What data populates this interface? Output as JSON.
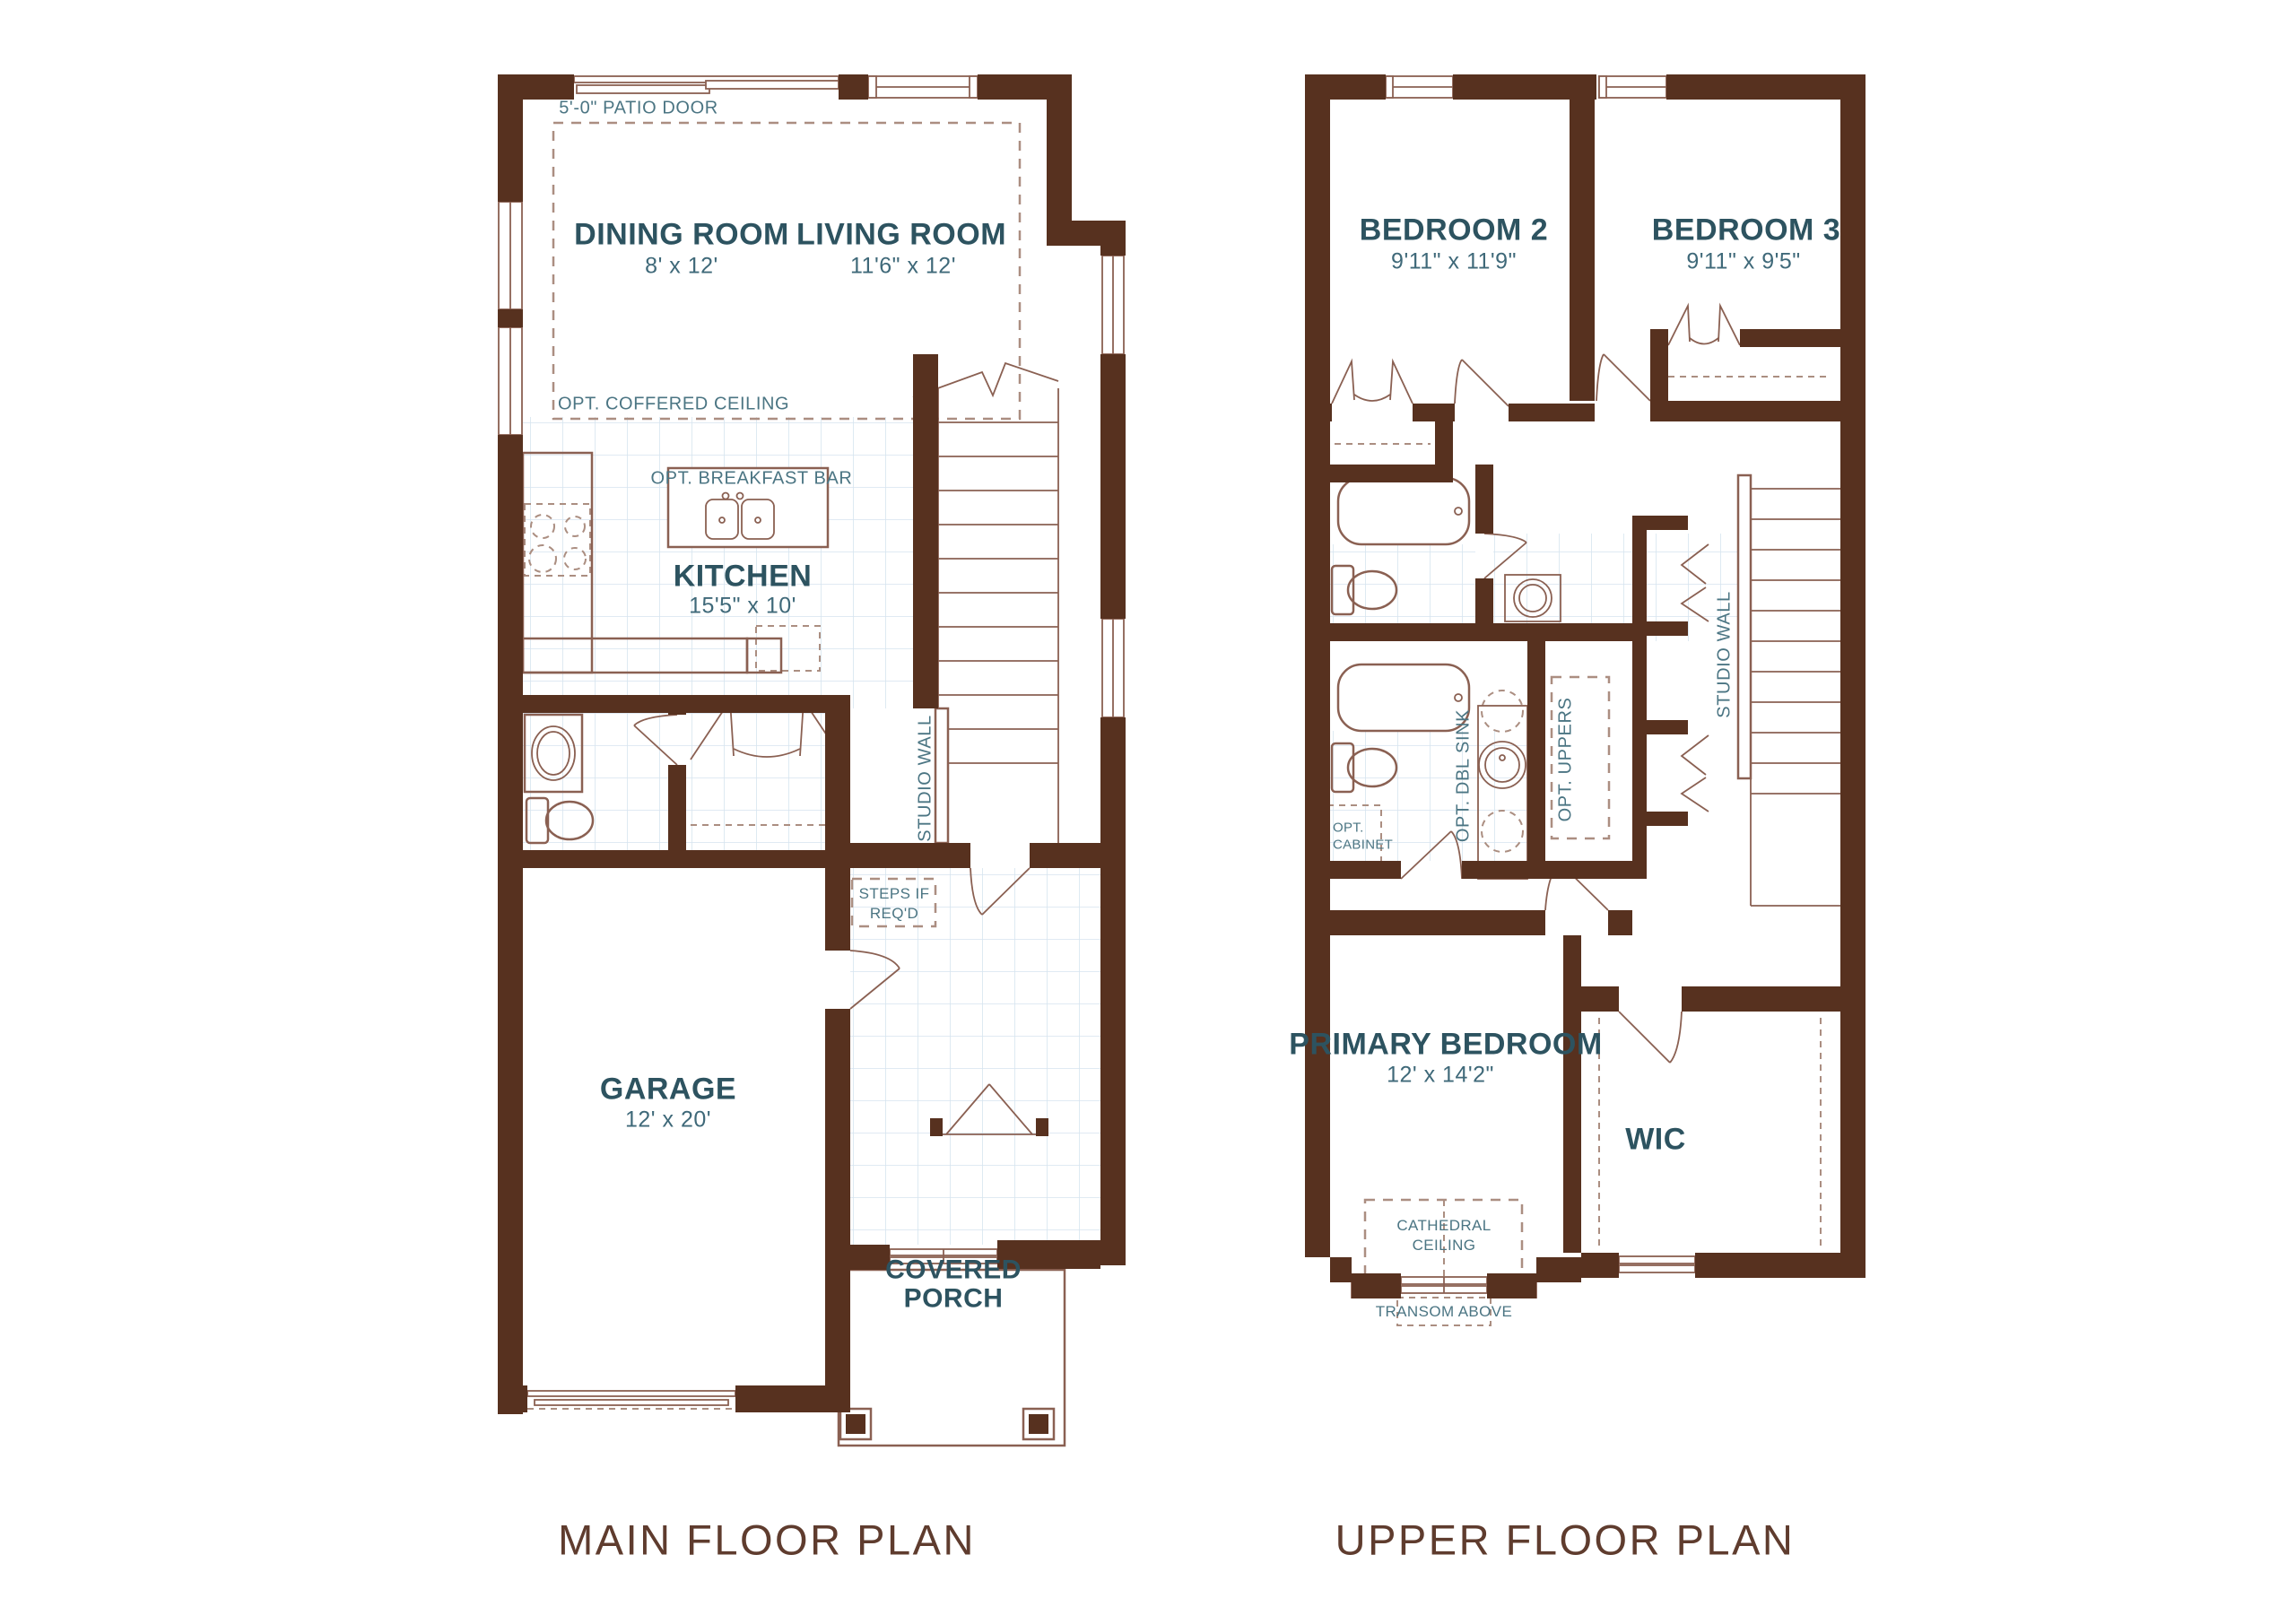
{
  "colors": {
    "wall": "#57311f",
    "line": "#8a6052",
    "dashed": "#ab8e81",
    "tile_grid": "#d6e4ef",
    "room_label": "#2d5360",
    "annotation": "#4b7583",
    "title": "#5f3c2e"
  },
  "main_floor": {
    "title": "MAIN FLOOR PLAN",
    "patio_door": "5'-0\" PATIO DOOR",
    "coffered": "OPT. COFFERED CEILING",
    "breakfast_bar": "OPT. BREAKFAST BAR",
    "studio_wall": "STUDIO WALL",
    "steps": "STEPS IF REQ'D",
    "dining": {
      "name": "DINING ROOM",
      "dims": "8' x 12'"
    },
    "living": {
      "name": "LIVING ROOM",
      "dims": "11'6\" x 12'"
    },
    "kitchen": {
      "name": "KITCHEN",
      "dims": "15'5\" x 10'"
    },
    "garage": {
      "name": "GARAGE",
      "dims": "12' x 20'"
    },
    "porch": {
      "name": "COVERED PORCH"
    }
  },
  "upper_floor": {
    "title": "UPPER FLOOR PLAN",
    "bedroom2": {
      "name": "BEDROOM 2",
      "dims": "9'11\" x 11'9\""
    },
    "bedroom3": {
      "name": "BEDROOM 3",
      "dims": "9'11\" x 9'5\""
    },
    "primary": {
      "name": "PRIMARY BEDROOM",
      "dims": "12' x 14'2\""
    },
    "wic": {
      "name": "WIC"
    },
    "dbl_sink": "OPT. DBL SINK",
    "uppers": "OPT. UPPERS",
    "cabinet": "OPT. CABINET",
    "studio_wall": "STUDIO WALL",
    "cathedral": "CATHEDRAL CEILING",
    "transom": "TRANSOM ABOVE"
  }
}
